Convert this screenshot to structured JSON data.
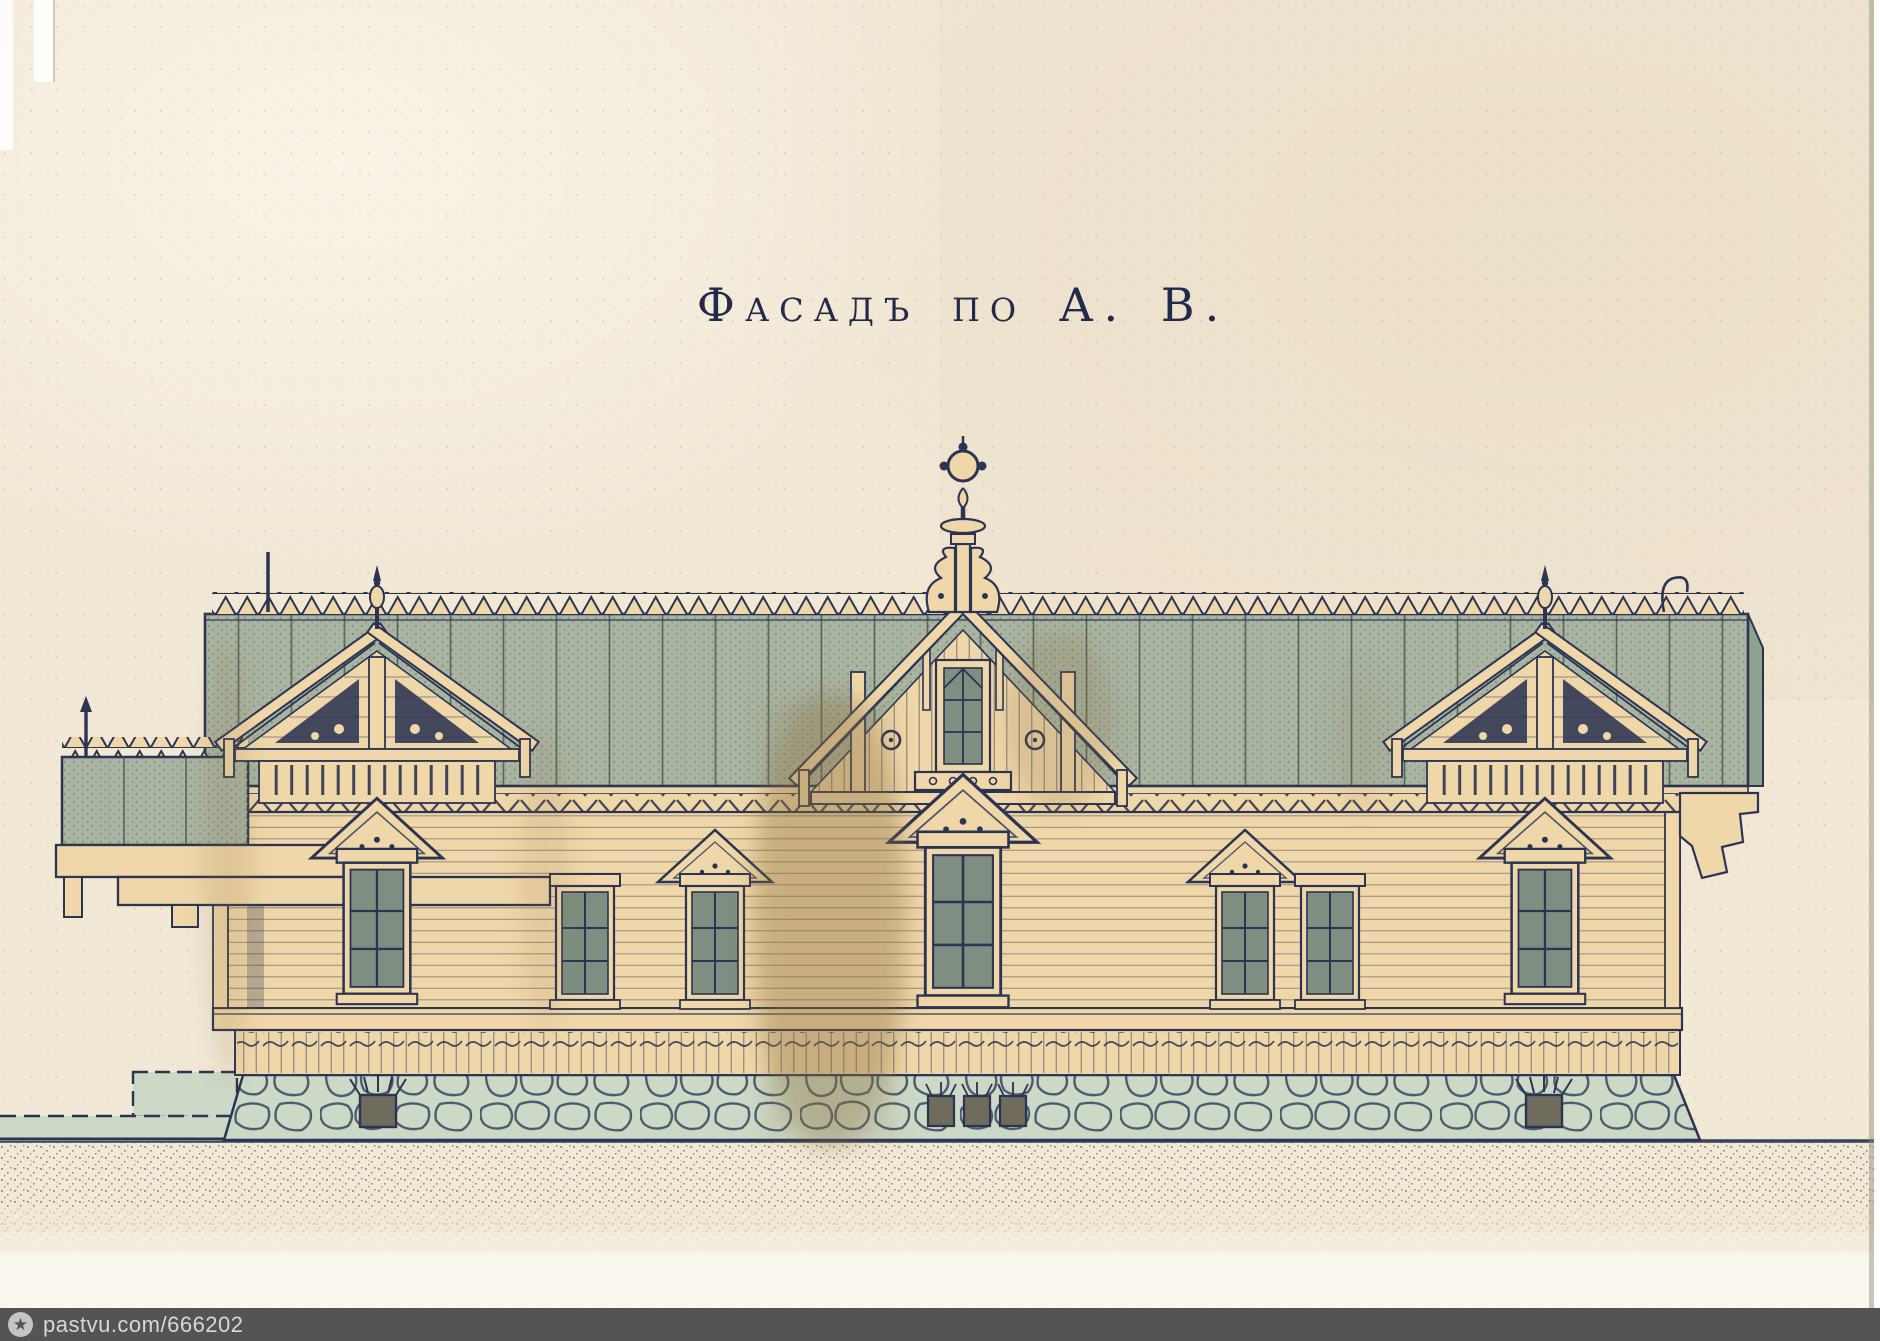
{
  "title": {
    "text": "Фасадъ по А. В."
  },
  "watermark": {
    "text": "pastvu.com/666202",
    "icon": "star-icon"
  },
  "colors": {
    "paper": "#f2e8d6",
    "paper-warm": "#ecdfc9",
    "title-ink": "#222a4a",
    "ink": "#2b3452",
    "roof": "#a8b3a2",
    "roof-shade": "#90a090",
    "wall": "#f0d7a9",
    "glass": "#7e8f81",
    "stone": "#ccd9c6",
    "stain": "#8d6f42",
    "ground": "#817e76",
    "vent": "#6f6b5d",
    "watermark-bar": "#545454",
    "watermark-text": "#d8d8d8",
    "watermark-logo": "#c4c4c4"
  }
}
